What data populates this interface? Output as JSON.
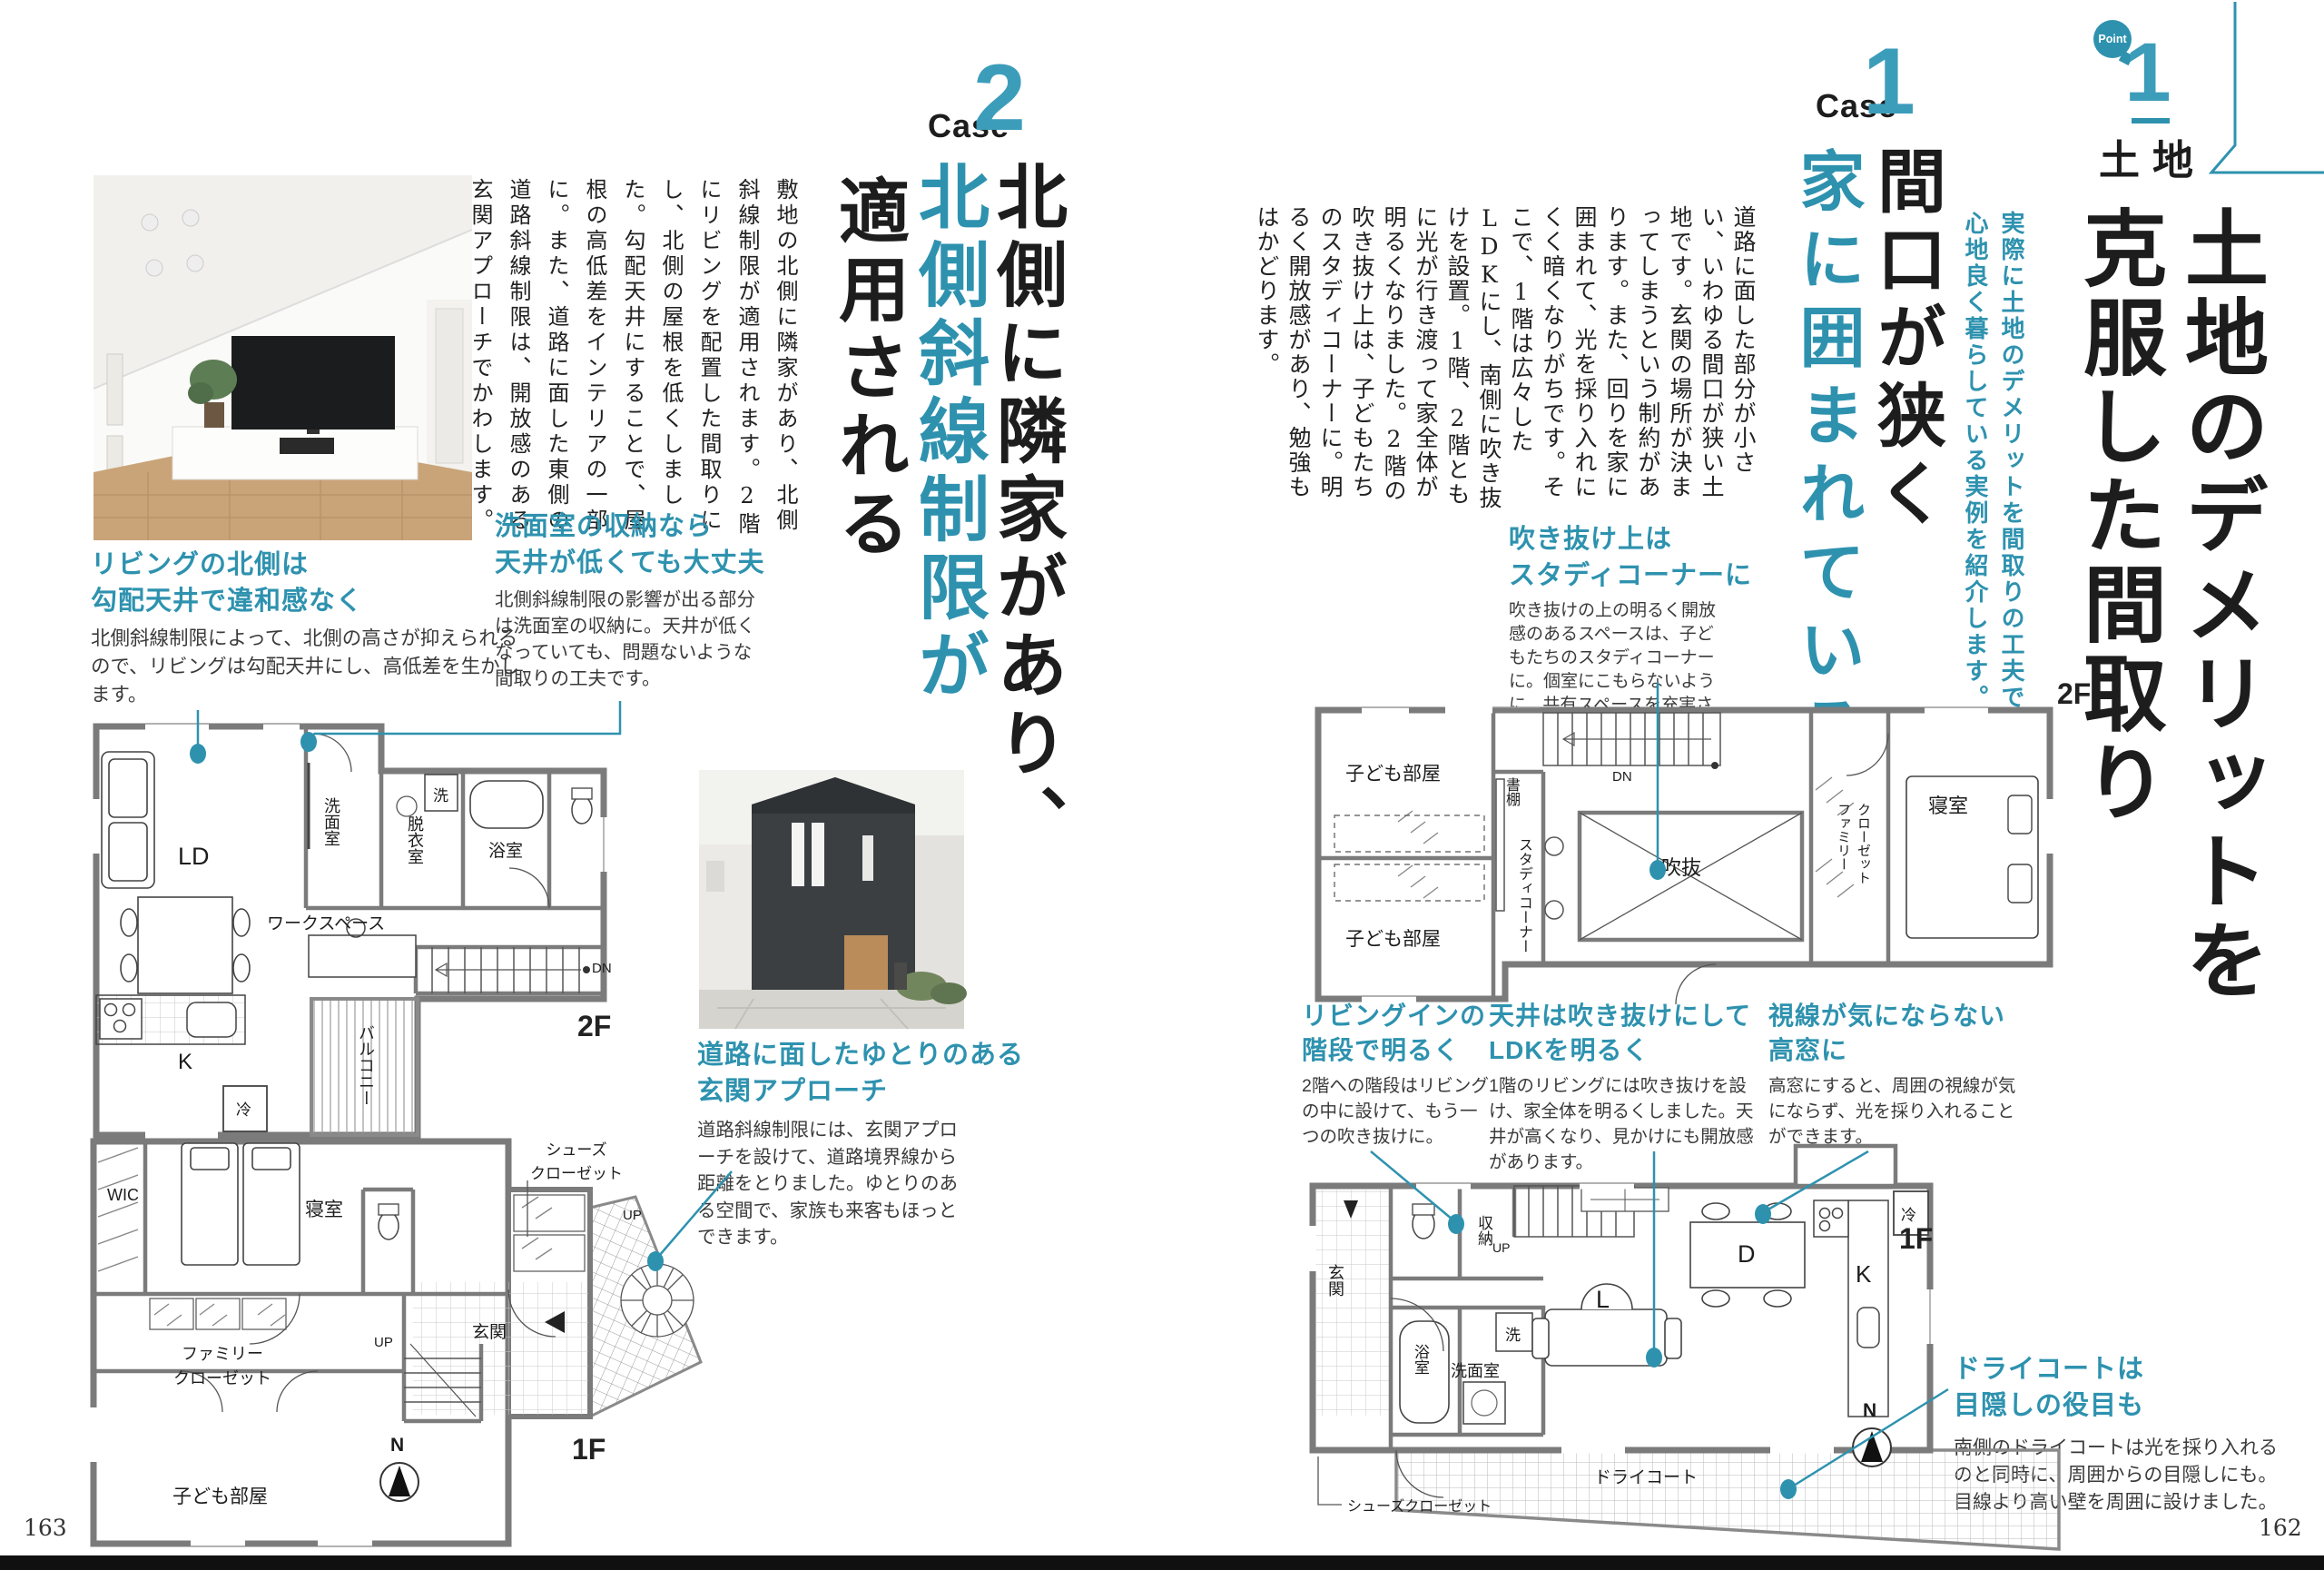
{
  "accent_color": "#2e92af",
  "right": {
    "page_number": "162",
    "badge": {
      "bubble": "Point",
      "number": "1",
      "category": "土地"
    },
    "main_title": {
      "line1": "土地のデメリットを",
      "line2": "克服した間取り"
    },
    "lead": {
      "line1": "実際に土地のデメリットを間取りの工夫で克服し、",
      "line2": "心地良く暮らしている実例を紹介します。"
    },
    "case1": {
      "label": "Case",
      "number": "1",
      "title_black": "間口が狭く",
      "title_accent": "家に囲まれている",
      "body": "道路に面した部分が小さい、いわゆる間口が狭い土地です。玄関の場所が決まってしまうという制約があります。また、回りを家に囲まれて、光を採り入れにくく暗くなりがちです。そこで、1階は広々したLDKにし、南側に吹き抜けを設置。1階、2階ともに光が行き渡って家全体が明るくなりました。2階の吹き抜け上は、子どもたちのスタディコーナーに。明るく開放感があり、勉強もはかどります。"
    },
    "callout_void": {
      "h1": "吹き抜け上は",
      "h2": "スタディコーナーに",
      "cap": "吹き抜けの上の明るく開放感のあるスペースは、子どもたちのスタディコーナーに。個室にこもらないように、共有スペースを充実させて。"
    },
    "callout_stair": {
      "h1": "リビングインの",
      "h2": "階段で明るく",
      "cap": "2階への階段はリビングの中に設けて、もう一つの吹き抜けに。"
    },
    "callout_ce": {
      "h1": "天井は吹き抜けにして",
      "h2": "LDKを明るく",
      "cap": "1階のリビングには吹き抜けを設け、家全体を明るくしました。天井が高くなり、見かけにも開放感があります。"
    },
    "callout_win": {
      "h1": "視線が気にならない",
      "h2": "高窓に",
      "cap": "高窓にすると、周囲の視線が気にならず、光を採り入れることができます。"
    },
    "callout_dry": {
      "h1": "ドライコートは",
      "h2": "目隠しの役目も",
      "cap": "南側のドライコートは光を採り入れるのと同時に、周囲からの目隠しにも。目線より高い壁を周囲に設けました。"
    },
    "plan2f": {
      "floor": "2F",
      "kids_top": "子ども部屋",
      "kids_bottom": "子ども部屋",
      "shelf": "書棚",
      "study": "スタディコーナー",
      "void": "吹抜",
      "closet1": "ファミリー",
      "closet2": "クローゼット",
      "bedroom": "寝室",
      "dn": "DN"
    },
    "plan1f": {
      "floor": "1F",
      "compass": "N",
      "entrance": "玄関",
      "storage": "収納",
      "up": "UP",
      "wash": "洗",
      "bath": "浴室",
      "lavatory": "洗面室",
      "living": "L",
      "dining": "D",
      "kitchen": "K",
      "fridge": "冷",
      "drycourt": "ドライコート",
      "shoes": "シューズクローゼット"
    }
  },
  "left": {
    "page_number": "163",
    "case2": {
      "label": "Case",
      "number": "2",
      "title_black1": "北側に隣家があり、",
      "title_accent": "北側斜線制限が",
      "title_black2": "適用される",
      "body": "敷地の北側に隣家があり、北側斜線制限が適用されます。2階にリビングを配置した間取りにし、北側の屋根を低くしました。勾配天井にすることで、屋根の高低差をインテリアの一部に。また、道路に面した東側の道路斜線制限は、開放感のある玄関アプローチでかわします。"
    },
    "callout_living": {
      "h1": "リビングの北側は",
      "h2": "勾配天井で違和感なく",
      "cap": "北側斜線制限によって、北側の高さが抑えられるので、リビングは勾配天井にし、高低差を生かします。"
    },
    "callout_lav": {
      "h1": "洗面室の収納なら",
      "h2": "天井が低くても大丈夫",
      "cap": "北側斜線制限の影響が出る部分は洗面室の収納に。天井が低くなっていても、問題ないような間取りの工夫です。"
    },
    "callout_app": {
      "h1": "道路に面したゆとりのある",
      "h2": "玄関アプローチ",
      "cap": "道路斜線制限には、玄関アプローチを設けて、道路境界線から距離をとりました。ゆとりのある空間で、家族も来客もほっとできます。"
    },
    "plan2f": {
      "floor": "2F",
      "ld": "LD",
      "lavatory": "洗面室",
      "wash": "洗",
      "dressing": "脱衣室",
      "bath": "浴室",
      "workspace": "ワークスペース",
      "dn": "DN",
      "balcony": "バルコニー",
      "kitchen": "K",
      "fridge": "冷"
    },
    "plan1f": {
      "floor": "1F",
      "compass": "N",
      "wic": "WIC",
      "bedroom": "寝室",
      "closet1": "ファミリー",
      "closet2": "クローゼット",
      "kids": "子ども部屋",
      "entrance": "玄関",
      "shoes1": "シューズ",
      "shoes2": "クローゼット",
      "up1": "UP",
      "up2": "UP"
    }
  }
}
